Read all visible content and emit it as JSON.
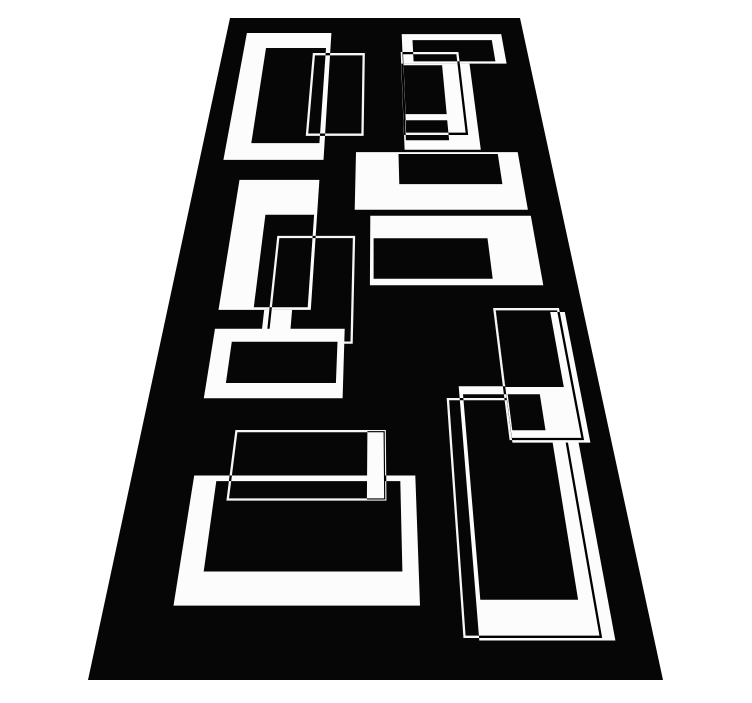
{
  "meta": {
    "alt": "Black and white modern geometric runner rug photographed in perspective on a white background, decorated with overlapping white rectangle frames and thin rectangle outlines"
  },
  "scene": {
    "canvas": {
      "width": 752,
      "height": 703
    },
    "background_color": "#ffffff",
    "rug": {
      "color": "#060606",
      "perspective": {
        "y_top": 18,
        "y_bottom": 680,
        "x_top_left": 230,
        "x_top_right": 520,
        "x_bot_left": 88,
        "x_bot_right": 663
      }
    },
    "pattern": {
      "color": "#fcfcfc",
      "thin_line_width": 2.3,
      "shapes": [
        {
          "name": "frame-top-left",
          "type": "frame",
          "outer": [
            6.8,
            4.4,
            35.3,
            35.1
          ],
          "holes": [
            [
              14.0,
              8.6,
              33.8,
              31.6
            ]
          ]
        },
        {
          "name": "outline-top-left",
          "type": "outline",
          "rect": [
            30.0,
            10.3,
            46.3,
            29.8
          ]
        },
        {
          "name": "ring-top-right",
          "type": "frame",
          "outer": [
            59.0,
            4.7,
            92.5,
            12.8
          ],
          "holes": [
            [
              62.5,
              6.4,
              89.0,
              12.2
            ]
          ]
        },
        {
          "name": "frame-top-right",
          "type": "frame",
          "outer": [
            58.5,
            12.8,
            80.5,
            33.0
          ],
          "holes": [
            [
              59.2,
              13.2,
              71.6,
              25.2
            ],
            [
              59.0,
              26.6,
              71.6,
              31.0
            ]
          ]
        },
        {
          "name": "outline-top-right",
          "type": "outline",
          "rect": [
            58.8,
            10.0,
            77.0,
            29.6
          ]
        },
        {
          "name": "bar-right-upper",
          "type": "frame",
          "outer": [
            44.5,
            33.5,
            91.0,
            44.7
          ],
          "holes": [
            [
              56.7,
              33.9,
              85.2,
              39.9
            ]
          ]
        },
        {
          "name": "bar-right-lower",
          "type": "frame",
          "outer": [
            48.7,
            45.8,
            91.5,
            57.3
          ],
          "holes": [
            [
              49.6,
              49.7,
              79.2,
              56.3
            ]
          ]
        },
        {
          "name": "frame-mid-left",
          "type": "frame",
          "outer": [
            12.3,
            39.1,
            34.5,
            61.0
          ],
          "holes": [
            [
              20.7,
              45.6,
              33.7,
              60.6
            ]
          ]
        },
        {
          "name": "bar-mid-left",
          "type": "bar",
          "rect": [
            23.3,
            61.0,
            30.0,
            66.3
          ]
        },
        {
          "name": "outline-mid-left",
          "type": "outline",
          "rect": [
            24.8,
            49.5,
            44.5,
            65.6
          ]
        },
        {
          "name": "frame-third-row-left",
          "type": "frame",
          "outer": [
            12.2,
            63.7,
            42.8,
            72.8
          ],
          "holes": [
            [
              16.6,
              65.5,
              41.2,
              70.9
            ]
          ]
        },
        {
          "name": "frame-bottom-left",
          "type": "frame",
          "outer": [
            12.8,
            81.6,
            58.2,
            94.0
          ],
          "holes": [
            [
              17.5,
              82.2,
              55.1,
              91.0
            ]
          ]
        },
        {
          "name": "bar-above-bottom-left",
          "type": "bar",
          "rect": [
            48.3,
            76.7,
            52.0,
            84.1
          ]
        },
        {
          "name": "outline-above-bottom-left",
          "type": "outline",
          "rect": [
            20.3,
            76.7,
            52.0,
            84.1
          ]
        },
        {
          "name": "frame-bottom-right",
          "type": "frame",
          "outer": [
            68.6,
            71.3,
            93.0,
            96.9
          ],
          "holes": [
            [
              69.4,
              72.3,
              87.5,
              93.5
            ]
          ]
        },
        {
          "name": "outline-bottom-right",
          "type": "outline",
          "rect": [
            66.0,
            72.9,
            90.5,
            96.6
          ]
        },
        {
          "name": "frame-third-row-right",
          "type": "frame",
          "outer": [
            79.0,
            61.3,
            95.5,
            78.0
          ],
          "holes": [
            [
              79.0,
              61.3,
              92.0,
              71.4
            ],
            [
              79.3,
              72.3,
              86.4,
              76.6
            ]
          ]
        },
        {
          "name": "outline-third-row-right",
          "type": "outline",
          "rect": [
            78.7,
            60.9,
            94.0,
            77.6
          ]
        }
      ]
    }
  }
}
